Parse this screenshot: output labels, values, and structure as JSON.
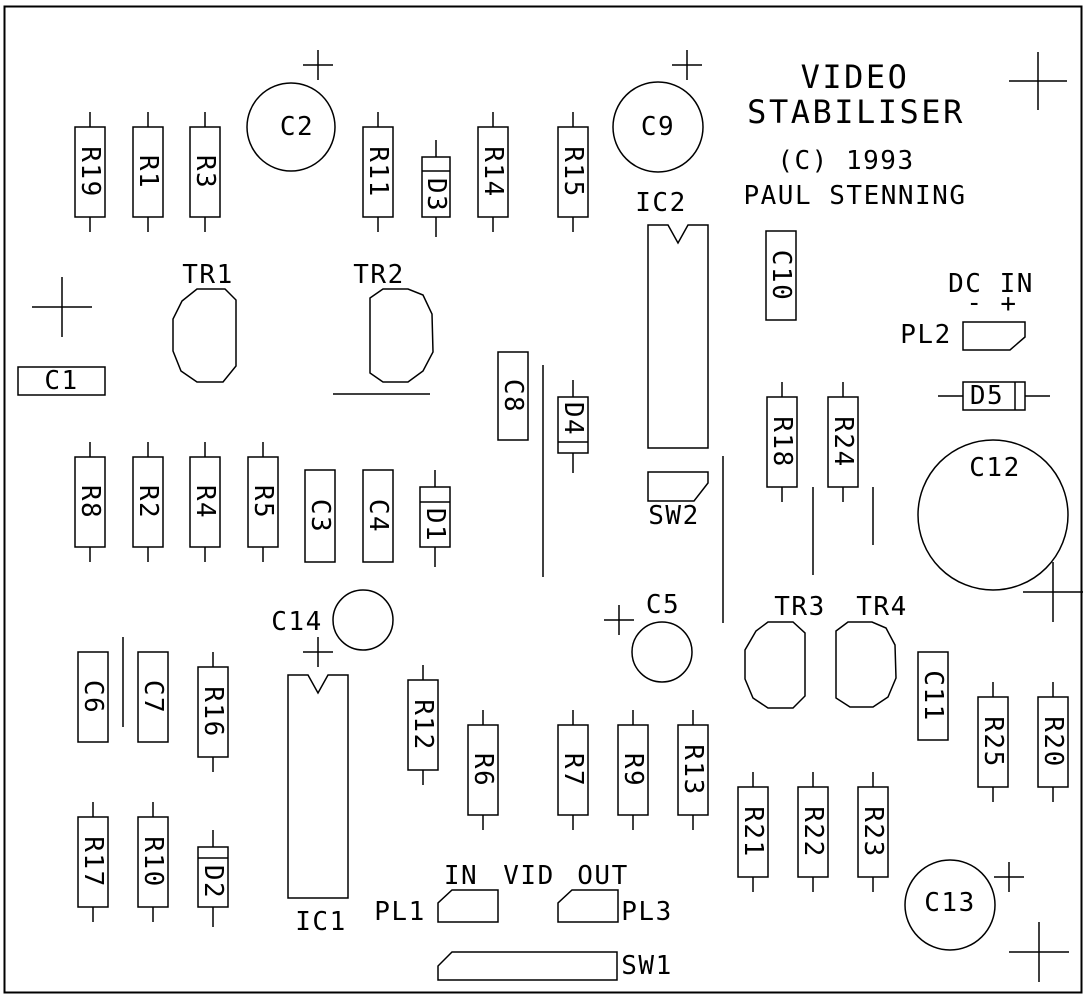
{
  "title_block": {
    "line1": "VIDEO",
    "line2": "STABILISER",
    "copyright": "(C) 1993",
    "author": "PAUL STENNING"
  },
  "colors": {
    "ink": "#000000",
    "background": "#ffffff"
  },
  "border": {
    "x": 4.5,
    "y": 6.5,
    "w": 1077,
    "h": 986
  },
  "components": {
    "resistors": [
      {
        "id": "R19",
        "x": 75,
        "y": 127
      },
      {
        "id": "R1",
        "x": 133,
        "y": 127
      },
      {
        "id": "R3",
        "x": 190,
        "y": 127
      },
      {
        "id": "R11",
        "x": 363,
        "y": 127
      },
      {
        "id": "R14",
        "x": 478,
        "y": 127
      },
      {
        "id": "R15",
        "x": 558,
        "y": 127
      },
      {
        "id": "R8",
        "x": 75,
        "y": 457
      },
      {
        "id": "R2",
        "x": 133,
        "y": 457
      },
      {
        "id": "R4",
        "x": 190,
        "y": 457
      },
      {
        "id": "R5",
        "x": 248,
        "y": 457
      },
      {
        "id": "R18",
        "x": 767,
        "y": 397
      },
      {
        "id": "R24",
        "x": 828,
        "y": 397
      },
      {
        "id": "R16",
        "x": 198,
        "y": 667
      },
      {
        "id": "R12",
        "x": 408,
        "y": 680
      },
      {
        "id": "R6",
        "x": 468,
        "y": 725
      },
      {
        "id": "R7",
        "x": 558,
        "y": 725
      },
      {
        "id": "R9",
        "x": 618,
        "y": 725
      },
      {
        "id": "R13",
        "x": 678,
        "y": 725
      },
      {
        "id": "R17",
        "x": 78,
        "y": 817
      },
      {
        "id": "R10",
        "x": 138,
        "y": 817
      },
      {
        "id": "R21",
        "x": 738,
        "y": 787
      },
      {
        "id": "R22",
        "x": 798,
        "y": 787
      },
      {
        "id": "R23",
        "x": 858,
        "y": 787
      },
      {
        "id": "R25",
        "x": 978,
        "y": 697
      },
      {
        "id": "R20",
        "x": 1038,
        "y": 697
      }
    ],
    "resistor_defaults": {
      "w": 30,
      "h": 90,
      "lead": 15
    },
    "capacitors_rect": [
      {
        "id": "C1",
        "x": 18,
        "y": 367,
        "w": 87,
        "h": 28,
        "orient": "h"
      },
      {
        "id": "C3",
        "x": 305,
        "y": 470,
        "w": 30,
        "h": 92,
        "orient": "v"
      },
      {
        "id": "C4",
        "x": 363,
        "y": 470,
        "w": 30,
        "h": 92,
        "orient": "v"
      },
      {
        "id": "C6",
        "x": 78,
        "y": 652,
        "w": 30,
        "h": 90,
        "orient": "v"
      },
      {
        "id": "C7",
        "x": 138,
        "y": 652,
        "w": 30,
        "h": 90,
        "orient": "v"
      },
      {
        "id": "C8",
        "x": 498,
        "y": 352,
        "w": 30,
        "h": 88,
        "orient": "v"
      },
      {
        "id": "C10",
        "x": 766,
        "y": 231,
        "w": 30,
        "h": 89,
        "orient": "v"
      },
      {
        "id": "C11",
        "x": 918,
        "y": 652,
        "w": 30,
        "h": 88,
        "orient": "v"
      }
    ],
    "capacitors_round": [
      {
        "id": "C2",
        "cx": 291,
        "cy": 127,
        "r": 44,
        "lx": 297,
        "ly": 127
      },
      {
        "id": "C9",
        "cx": 658,
        "cy": 127,
        "r": 45,
        "lx": 658,
        "ly": 127
      },
      {
        "id": "C5",
        "cx": 662,
        "cy": 652,
        "r": 30,
        "lx": 663,
        "ly": 605
      },
      {
        "id": "C14",
        "cx": 363,
        "cy": 620,
        "r": 30,
        "lx": 297,
        "ly": 622
      },
      {
        "id": "C12",
        "cx": 993,
        "cy": 515,
        "r": 75,
        "lx": 995,
        "ly": 468
      },
      {
        "id": "C13",
        "cx": 950,
        "cy": 905,
        "r": 45,
        "lx": 950,
        "ly": 903
      }
    ],
    "diodes": [
      {
        "id": "D3",
        "x": 422,
        "y": 157,
        "w": 28,
        "h": 60,
        "orient": "v",
        "bar_pos": 171,
        "lx": 436,
        "ly": 195
      },
      {
        "id": "D1",
        "x": 420,
        "y": 487,
        "w": 30,
        "h": 60,
        "orient": "v",
        "bar_pos": 502,
        "lx": 435,
        "ly": 525
      },
      {
        "id": "D2",
        "x": 198,
        "y": 847,
        "w": 30,
        "h": 60,
        "orient": "v",
        "bar_pos": 858,
        "lx": 213,
        "ly": 882
      },
      {
        "id": "D4",
        "x": 558,
        "y": 397,
        "w": 30,
        "h": 56,
        "orient": "v",
        "bar_pos": 442,
        "lx": 573,
        "ly": 419
      },
      {
        "id": "D5",
        "x": 963,
        "y": 382,
        "w": 62,
        "h": 28,
        "orient": "h",
        "bar_pos": 1015,
        "lx": 987,
        "ly": 396
      }
    ],
    "ics": [
      {
        "id": "IC1",
        "x": 288,
        "y": 675,
        "w": 60,
        "h": 223,
        "lx": 321,
        "ly": 922
      },
      {
        "id": "IC2",
        "x": 648,
        "y": 225,
        "w": 60,
        "h": 223,
        "lx": 661,
        "ly": 203
      }
    ],
    "transistors": [
      {
        "id": "TR1",
        "points": "197,289 225,289 236,300 236,366 223,382 197,382 181,371 173,351 173,319 182,301",
        "lx": 208,
        "ly": 275
      },
      {
        "id": "TR2",
        "points": "370,298 383,289 408,289 423,295 432,314 433,352 423,371 408,382 383,382 370,373",
        "lx": 379,
        "ly": 275
      },
      {
        "id": "TR3",
        "points": "768,622 793,622 805,633 805,696 793,708 768,708 753,698 745,679 745,650 756,631",
        "lx": 800,
        "ly": 607
      },
      {
        "id": "TR4",
        "points": "836,631 848,622 872,622 886,628 895,645 896,678 888,697 873,707 850,707 836,698",
        "lx": 882,
        "ly": 607
      }
    ],
    "connectors": [
      {
        "id": "PL1",
        "points": "452,890 498,890 498,922 438,922 438,903",
        "lx": 400,
        "ly": 912
      },
      {
        "id": "PL2",
        "points": "963,322 1025,322 1025,337 1010,350 963,350",
        "lx": 926,
        "ly": 335
      },
      {
        "id": "PL3",
        "points": "572,890 618,890 618,922 558,922 558,903",
        "lx": 647,
        "ly": 912
      },
      {
        "id": "SW1",
        "points": "452,952 617,952 617,980 438,980 438,966",
        "lx": 647,
        "ly": 966
      },
      {
        "id": "SW2",
        "points": "648,472 708,472 708,483 694,501 648,501",
        "lx": 674,
        "ly": 516
      }
    ],
    "lines": [
      {
        "x1": 333,
        "y1": 394,
        "x2": 430,
        "y2": 394
      },
      {
        "x1": 543,
        "y1": 365,
        "x2": 543,
        "y2": 577
      },
      {
        "x1": 723,
        "y1": 456,
        "x2": 723,
        "y2": 623
      },
      {
        "x1": 813,
        "y1": 487,
        "x2": 813,
        "y2": 575
      },
      {
        "x1": 873,
        "y1": 487,
        "x2": 873,
        "y2": 545
      },
      {
        "x1": 123,
        "y1": 637,
        "x2": 123,
        "y2": 727
      }
    ],
    "crosshairs": [
      {
        "x": 318,
        "y": 65,
        "r": 15
      },
      {
        "x": 687,
        "y": 65,
        "r": 15
      },
      {
        "x": 1038,
        "y": 81,
        "r": 29
      },
      {
        "x": 62,
        "y": 307,
        "r": 30
      },
      {
        "x": 318,
        "y": 652,
        "r": 15
      },
      {
        "x": 619,
        "y": 620,
        "r": 15
      },
      {
        "x": 1053,
        "y": 592,
        "r": 30
      },
      {
        "x": 1009,
        "y": 877,
        "r": 15
      },
      {
        "x": 1039,
        "y": 952,
        "r": 30
      }
    ],
    "annotations": [
      {
        "text": "DC IN",
        "x": 991,
        "y": 284
      },
      {
        "text": "-",
        "x": 975,
        "y": 303
      },
      {
        "text": "+",
        "x": 1009,
        "y": 304
      },
      {
        "text": "IN",
        "x": 461,
        "y": 876
      },
      {
        "text": "VID",
        "x": 529,
        "y": 876
      },
      {
        "text": "OUT",
        "x": 603,
        "y": 876
      }
    ]
  }
}
